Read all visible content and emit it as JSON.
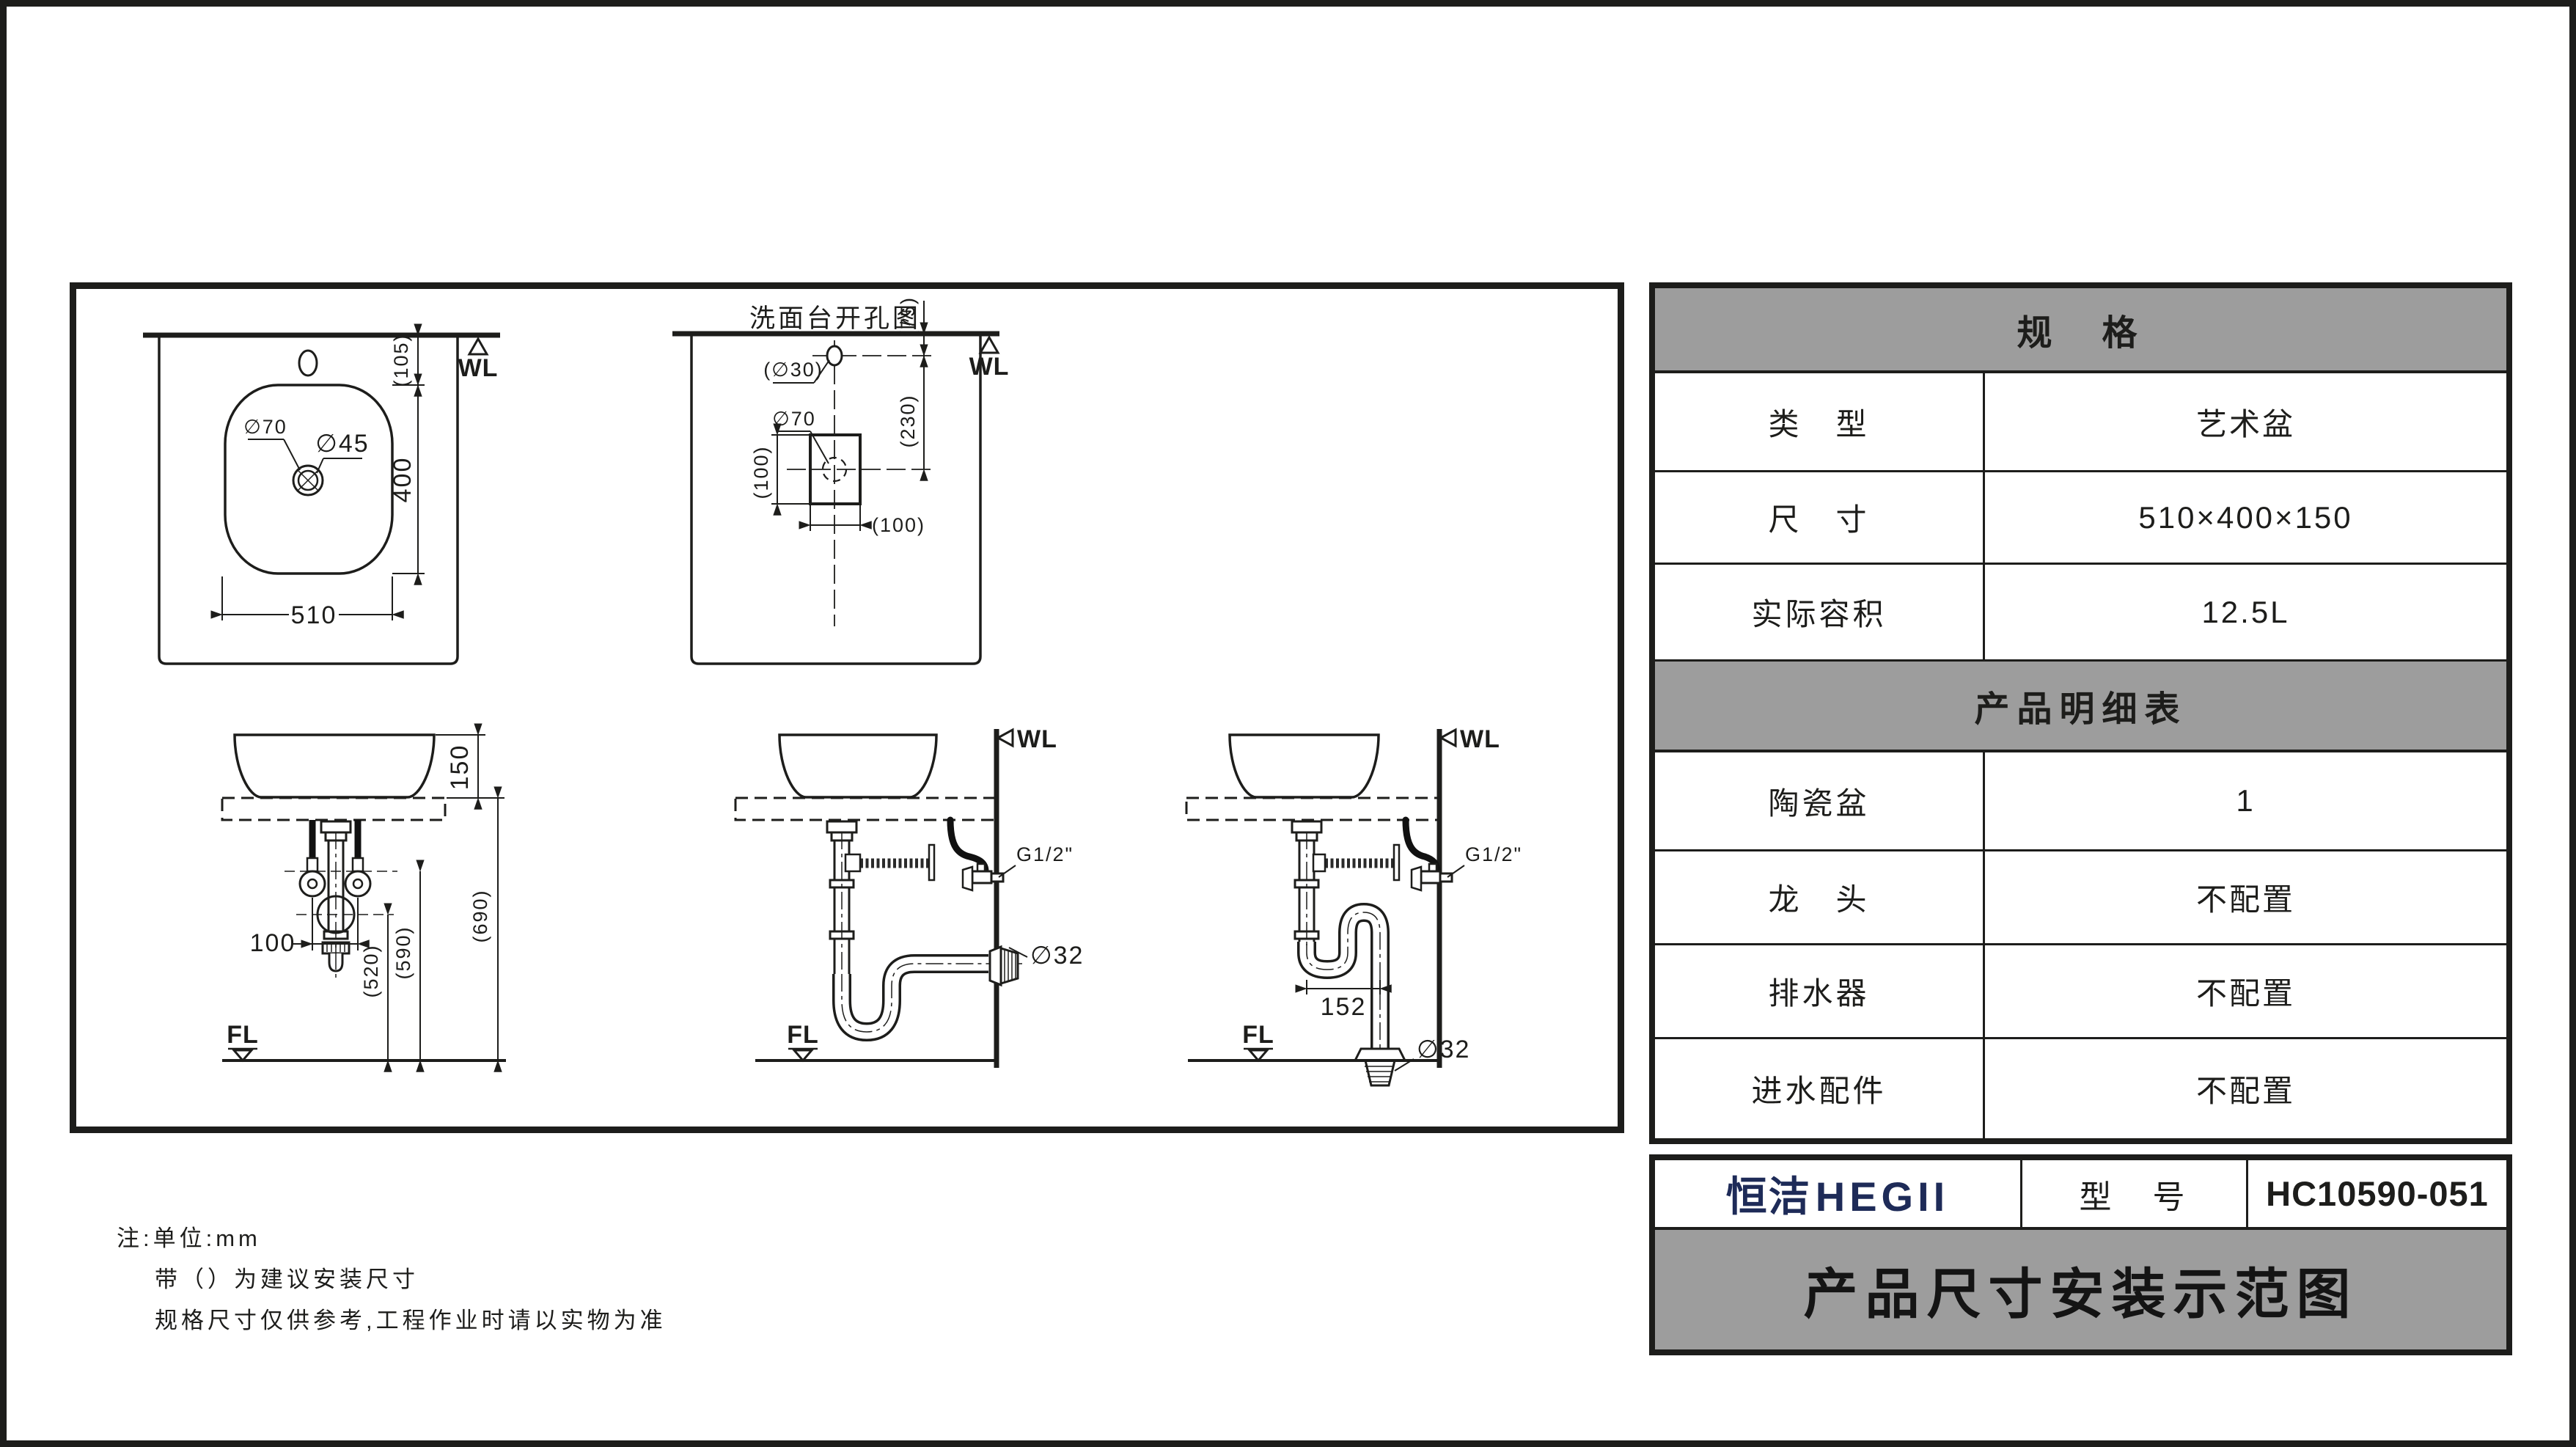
{
  "colors": {
    "ink": "#1d1d1b",
    "gray": "#9d9d9d",
    "navy": "#1e2b58"
  },
  "drawing": {
    "plan": {
      "wl": "WL",
      "dia70": "∅70",
      "dia45": "∅45",
      "dim105": "(105)",
      "dim400": "400",
      "dim510": "510"
    },
    "cutout": {
      "title": "洗面台开孔图",
      "wl": "WL",
      "dia30": "(∅30)",
      "dia70": "∅70",
      "dim100v": "(100)",
      "dim100h": "(100)",
      "dim75": "(75)",
      "dim230": "(230)"
    },
    "front": {
      "dim150": "150",
      "dim690": "(690)",
      "dim590": "(590)",
      "dim520": "(520)",
      "dim100": "100",
      "fl": "FL"
    },
    "wall_drain": {
      "wl": "WL",
      "g12": "G1/2\"",
      "dia32": "∅32",
      "fl": "FL"
    },
    "floor_drain": {
      "wl": "WL",
      "g12": "G1/2\"",
      "dim152": "152",
      "dia32": "∅32",
      "fl": "FL"
    }
  },
  "spec_table": {
    "title": "规　格",
    "rows": [
      {
        "label": "类　型",
        "value": "艺术盆"
      },
      {
        "label": "尺　寸",
        "value": "510×400×150"
      },
      {
        "label": "实际容积",
        "value": "12.5L"
      }
    ],
    "detail_title": "产品明细表",
    "detail_rows": [
      {
        "label": "陶瓷盆",
        "value": "1"
      },
      {
        "label": "龙　头",
        "value": "不配置"
      },
      {
        "label": "排水器",
        "value": "不配置"
      },
      {
        "label": "进水配件",
        "value": "不配置"
      }
    ]
  },
  "title_block": {
    "brand_cn": "恒洁",
    "brand_en": "HEGII",
    "model_label": "型　号",
    "model_value": "HC10590-051",
    "doc_title": "产品尺寸安装示范图"
  },
  "notes": {
    "line1": "注:单位:mm",
    "line2": "带（）为建议安装尺寸",
    "line3": "规格尺寸仅供参考,工程作业时请以实物为准"
  }
}
